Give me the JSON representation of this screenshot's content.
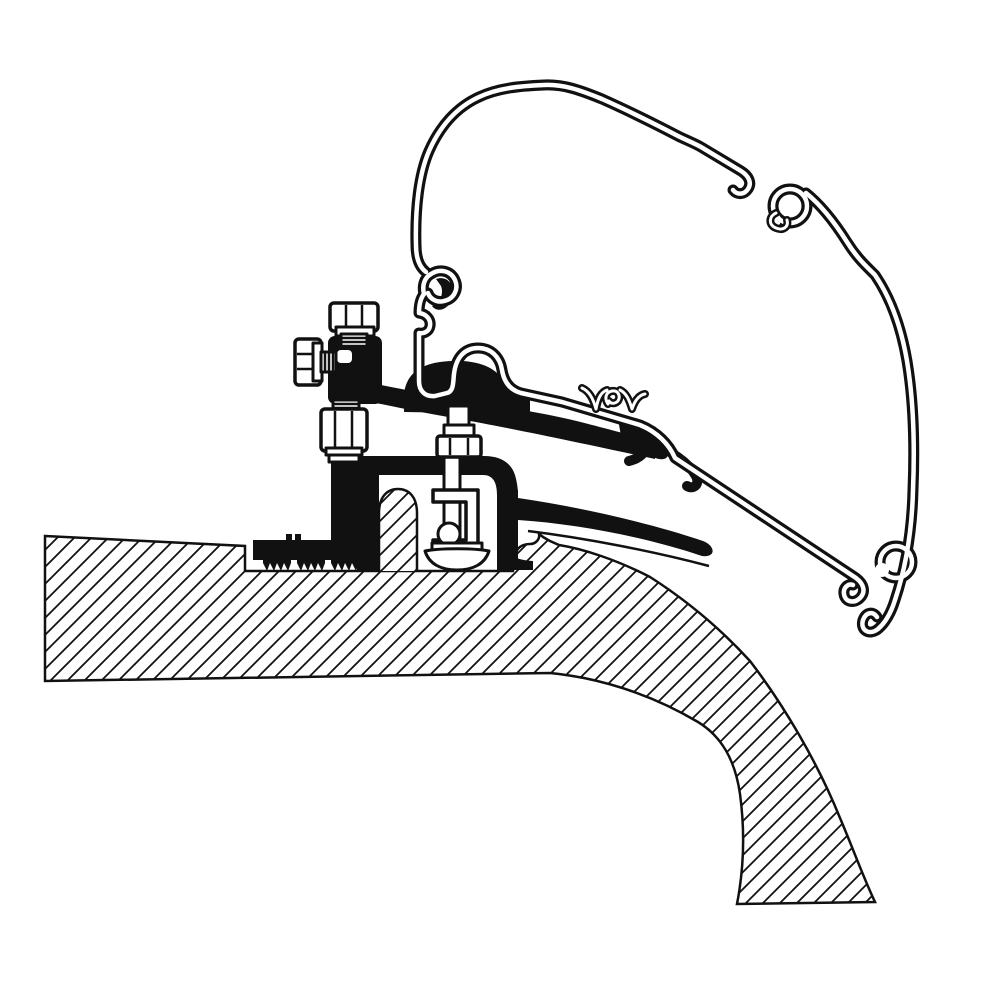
{
  "figure": {
    "kind": "technical-cross-section-illustration",
    "subject": "awning-rail-adapter-bracket-on-curved-vehicle-roof",
    "visible_text": []
  },
  "colors": {
    "ink": "#111111",
    "paper": "#ffffff"
  },
  "components": [
    "roof-cross-section-hatched",
    "roof-mounting-rib",
    "awning-rail-profile-outline",
    "profile-top-c-clip",
    "profile-bottom-c-hook",
    "adapter-bracket-black",
    "serrated-base-feet",
    "clamp-body",
    "rubber-seal-lip",
    "vertical-clamp-bolt",
    "top-adjustment-bolt",
    "side-adjustment-bolt",
    "lock-nut-and-washer"
  ]
}
